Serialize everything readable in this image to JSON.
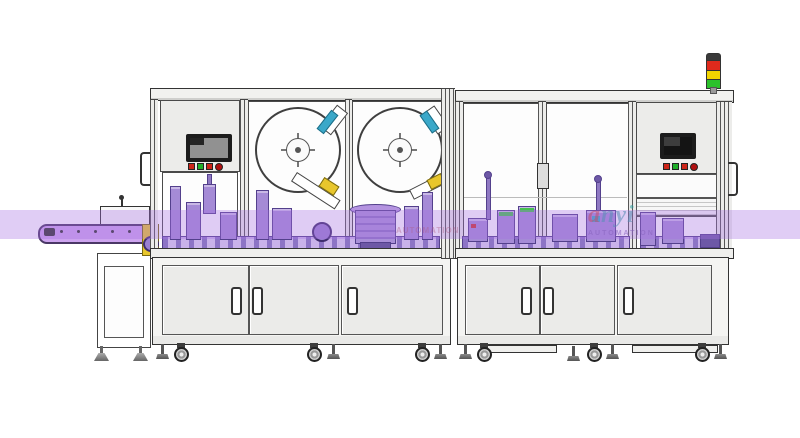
{
  "meta": {
    "description": "CAD side-view drawing of an automatic assembly and labeling machine line with infeed conveyor, two enclosed machine cabinets, label reels, HMI panels and signal tower"
  },
  "theme": {
    "band-purple": "#a770e2",
    "machinery": "#a58bd6",
    "machinery-dark": "#53408c",
    "belt-purple": "#cda4ef",
    "accent-yellow": "#e8c62c",
    "accent-teal": "#3aa8c9",
    "accent-green": "#46c050",
    "btn-red": "#cc2418",
    "btn-green": "#1fae28",
    "lamp-red": "#e02a1c",
    "lamp-yellow": "#f2d500",
    "lamp-green": "#2bc12b",
    "panel": "#ececea",
    "line": "#3a3a3a"
  },
  "signal_tower": {
    "segments": [
      "red",
      "yellow",
      "green"
    ]
  },
  "hmi": {
    "left_buttons": [
      "red",
      "green",
      "red",
      "red-round"
    ],
    "right_buttons": [
      "red",
      "green",
      "red",
      "red-round"
    ]
  },
  "watermark": {
    "brand_a": "a",
    "brand_rest": "nyi",
    "subtext": "AUTOMATION",
    "ghost": "AUTOMATION"
  }
}
